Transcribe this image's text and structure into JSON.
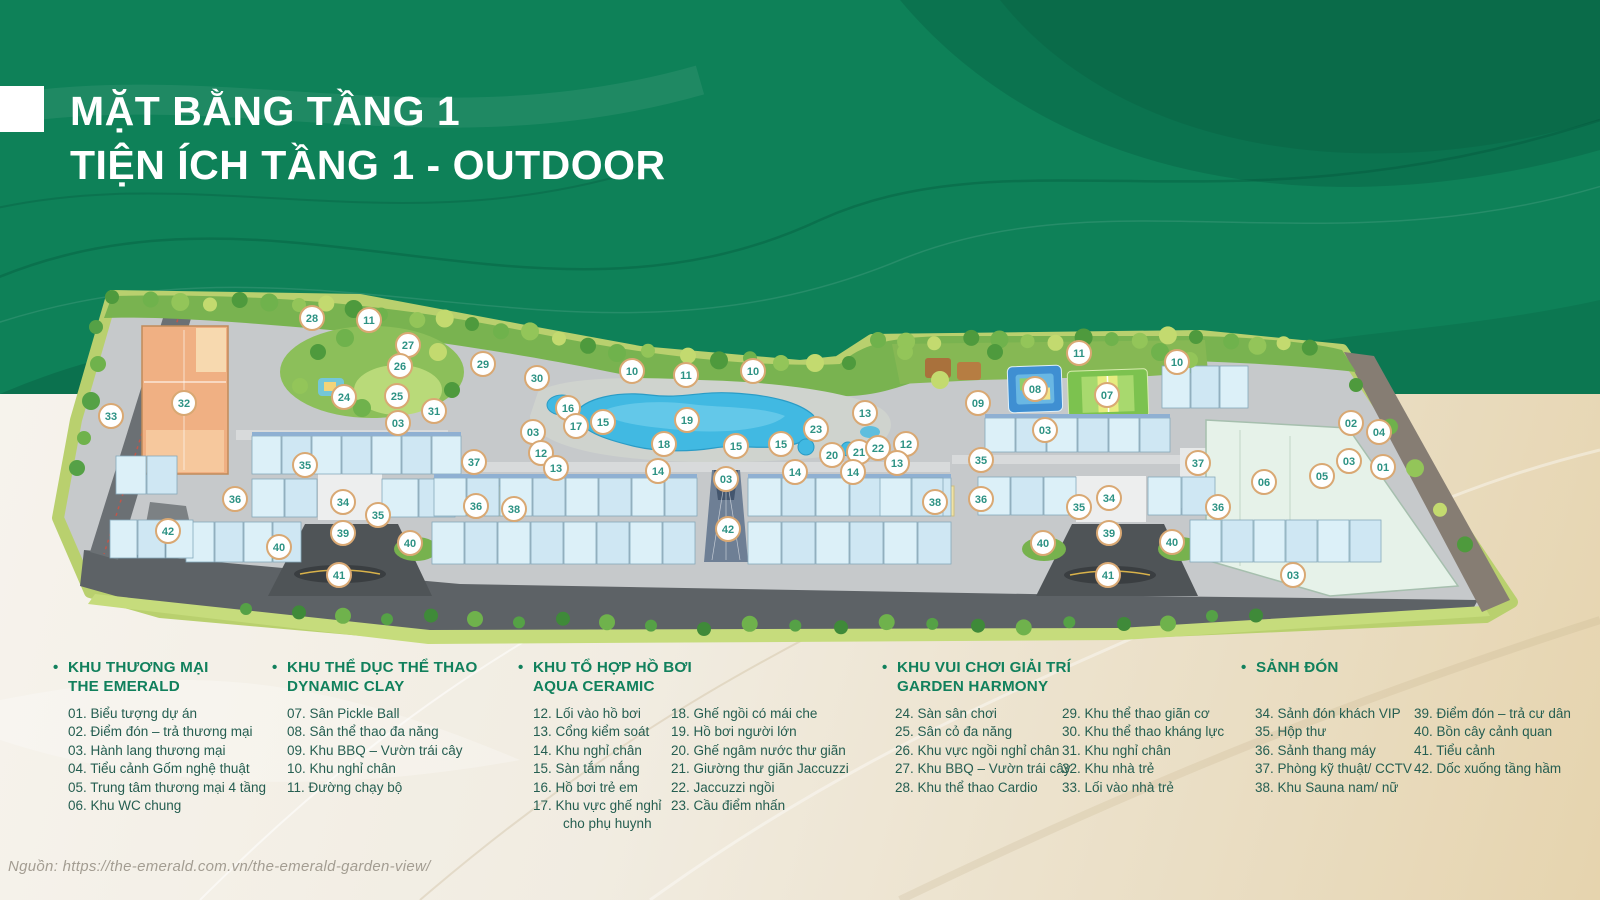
{
  "page": {
    "title_line1": "MẶT BẰNG TẦNG 1",
    "title_line2": "TIỆN ÍCH TẦNG 1 - OUTDOOR",
    "source": "Nguồn: https://the-emerald.com.vn/the-emerald-garden-view/"
  },
  "colors": {
    "background_green": "#0e8158",
    "background_sand": "#e9dcc0",
    "title_text": "#ffffff",
    "legend_header": "#11805c",
    "legend_item": "#255e51",
    "marker_border": "#d9a873",
    "marker_number": "#2d9284",
    "pool_blue": "#41b9e2",
    "building_blue": "#d8edf6",
    "building_orange": "#f0b083",
    "lawn_green": "#b9d06e",
    "road_gray": "#5d6266"
  },
  "legend": {
    "groups": [
      {
        "title_lines": [
          "KHU THƯƠNG MẠI",
          "THE EMERALD"
        ],
        "columns": [
          {
            "items": [
              "01. Biểu tượng dự án",
              "02. Điểm đón – trả thương mại",
              "03. Hành lang thương mại",
              "04. Tiểu cảnh Gốm nghệ thuật",
              "05. Trung tâm thương mại 4 tầng",
              "06. Khu WC chung"
            ]
          }
        ]
      },
      {
        "title_lines": [
          "KHU THỂ DỤC THỂ THAO",
          "DYNAMIC CLAY"
        ],
        "columns": [
          {
            "items": [
              "07. Sân Pickle Ball",
              "08. Sân thể thao đa năng",
              "09. Khu BBQ – Vườn trái cây",
              "10. Khu nghỉ chân",
              "11. Đường chạy bộ"
            ]
          }
        ]
      },
      {
        "title_lines": [
          "KHU TỔ HỢP HỒ BƠI",
          "AQUA CERAMIC"
        ],
        "columns": [
          {
            "items": [
              "12. Lối vào hồ bơi",
              "13. Cổng kiểm soát",
              "14. Khu nghỉ chân",
              "15. Sàn tắm nắng",
              "16. Hồ bơi trẻ em",
              "17. Khu vực ghế nghỉ\ncho phụ huynh"
            ]
          },
          {
            "items": [
              "18. Ghế ngồi có mái che",
              "19. Hồ bơi người lớn",
              "20. Ghế ngâm nước thư giãn",
              "21. Giường thư giãn Jaccuzzi",
              "22. Jaccuzzi ngồi",
              "23. Cầu điểm nhấn"
            ]
          }
        ]
      },
      {
        "title_lines": [
          "KHU VUI CHƠI GIẢI TRÍ",
          "GARDEN HARMONY"
        ],
        "columns": [
          {
            "items": [
              "24. Sàn sân chơi",
              "25. Sân cỏ đa năng",
              "26. Khu vực ngồi nghỉ chân",
              "27. Khu BBQ – Vườn trái cây",
              "28. Khu thể thao Cardio"
            ]
          },
          {
            "items": [
              "29. Khu thể thao giãn cơ",
              "30. Khu thể thao kháng lực",
              "31. Khu nghỉ chân",
              "32. Khu nhà trẻ",
              "33. Lối vào nhà trẻ"
            ]
          }
        ]
      },
      {
        "title_lines": [
          "SẢNH ĐÓN"
        ],
        "columns": [
          {
            "items": [
              "34. Sảnh đón khách VIP",
              "35. Hộp thư",
              "36. Sảnh thang máy",
              "37. Phòng kỹ thuật/ CCTV",
              "38. Khu Sauna nam/ nữ"
            ]
          },
          {
            "items": [
              "39. Điểm đón – trả cư dân",
              "40. Bồn cây cảnh quan",
              "41. Tiểu cảnh",
              "42. Dốc xuống tầng hầm"
            ]
          }
        ]
      }
    ]
  },
  "plan": {
    "markers": [
      {
        "n": "28",
        "x": 312,
        "y": 318
      },
      {
        "n": "11",
        "x": 369,
        "y": 320
      },
      {
        "n": "27",
        "x": 408,
        "y": 345
      },
      {
        "n": "26",
        "x": 400,
        "y": 366
      },
      {
        "n": "24",
        "x": 344,
        "y": 397
      },
      {
        "n": "25",
        "x": 397,
        "y": 396
      },
      {
        "n": "31",
        "x": 434,
        "y": 411
      },
      {
        "n": "29",
        "x": 483,
        "y": 364
      },
      {
        "n": "30",
        "x": 537,
        "y": 378
      },
      {
        "n": "32",
        "x": 184,
        "y": 403
      },
      {
        "n": "33",
        "x": 111,
        "y": 416
      },
      {
        "n": "03",
        "x": 398,
        "y": 423
      },
      {
        "n": "03",
        "x": 533,
        "y": 432
      },
      {
        "n": "12",
        "x": 541,
        "y": 453
      },
      {
        "n": "13",
        "x": 556,
        "y": 468
      },
      {
        "n": "35",
        "x": 305,
        "y": 465
      },
      {
        "n": "37",
        "x": 474,
        "y": 462
      },
      {
        "n": "36",
        "x": 235,
        "y": 499
      },
      {
        "n": "34",
        "x": 343,
        "y": 502
      },
      {
        "n": "35",
        "x": 378,
        "y": 515
      },
      {
        "n": "36",
        "x": 476,
        "y": 506
      },
      {
        "n": "38",
        "x": 514,
        "y": 509
      },
      {
        "n": "42",
        "x": 168,
        "y": 531
      },
      {
        "n": "40",
        "x": 279,
        "y": 547
      },
      {
        "n": "39",
        "x": 343,
        "y": 533
      },
      {
        "n": "40",
        "x": 410,
        "y": 543
      },
      {
        "n": "41",
        "x": 339,
        "y": 575
      },
      {
        "n": "10",
        "x": 632,
        "y": 371
      },
      {
        "n": "11",
        "x": 686,
        "y": 375
      },
      {
        "n": "10",
        "x": 753,
        "y": 371
      },
      {
        "n": "16",
        "x": 568,
        "y": 408
      },
      {
        "n": "17",
        "x": 576,
        "y": 426
      },
      {
        "n": "15",
        "x": 603,
        "y": 422
      },
      {
        "n": "19",
        "x": 687,
        "y": 420
      },
      {
        "n": "18",
        "x": 664,
        "y": 444
      },
      {
        "n": "15",
        "x": 736,
        "y": 446
      },
      {
        "n": "15",
        "x": 781,
        "y": 444
      },
      {
        "n": "23",
        "x": 816,
        "y": 429
      },
      {
        "n": "13",
        "x": 865,
        "y": 413
      },
      {
        "n": "20",
        "x": 832,
        "y": 455
      },
      {
        "n": "21",
        "x": 859,
        "y": 452
      },
      {
        "n": "22",
        "x": 878,
        "y": 448
      },
      {
        "n": "12",
        "x": 906,
        "y": 444
      },
      {
        "n": "13",
        "x": 897,
        "y": 463
      },
      {
        "n": "14",
        "x": 658,
        "y": 471
      },
      {
        "n": "03",
        "x": 726,
        "y": 479
      },
      {
        "n": "14",
        "x": 795,
        "y": 472
      },
      {
        "n": "14",
        "x": 853,
        "y": 472
      },
      {
        "n": "42",
        "x": 728,
        "y": 529
      },
      {
        "n": "09",
        "x": 978,
        "y": 403
      },
      {
        "n": "08",
        "x": 1035,
        "y": 389
      },
      {
        "n": "07",
        "x": 1107,
        "y": 395
      },
      {
        "n": "11",
        "x": 1079,
        "y": 353
      },
      {
        "n": "10",
        "x": 1177,
        "y": 362
      },
      {
        "n": "03",
        "x": 1045,
        "y": 430
      },
      {
        "n": "35",
        "x": 981,
        "y": 460
      },
      {
        "n": "38",
        "x": 935,
        "y": 502
      },
      {
        "n": "36",
        "x": 981,
        "y": 499
      },
      {
        "n": "34",
        "x": 1109,
        "y": 498
      },
      {
        "n": "35",
        "x": 1079,
        "y": 507
      },
      {
        "n": "37",
        "x": 1198,
        "y": 463
      },
      {
        "n": "36",
        "x": 1218,
        "y": 507
      },
      {
        "n": "06",
        "x": 1264,
        "y": 482
      },
      {
        "n": "05",
        "x": 1322,
        "y": 476
      },
      {
        "n": "02",
        "x": 1351,
        "y": 423
      },
      {
        "n": "04",
        "x": 1379,
        "y": 432
      },
      {
        "n": "03",
        "x": 1349,
        "y": 461
      },
      {
        "n": "01",
        "x": 1383,
        "y": 467
      },
      {
        "n": "39",
        "x": 1109,
        "y": 533
      },
      {
        "n": "40",
        "x": 1043,
        "y": 543
      },
      {
        "n": "40",
        "x": 1172,
        "y": 542
      },
      {
        "n": "41",
        "x": 1108,
        "y": 575
      },
      {
        "n": "03",
        "x": 1293,
        "y": 575
      }
    ]
  }
}
